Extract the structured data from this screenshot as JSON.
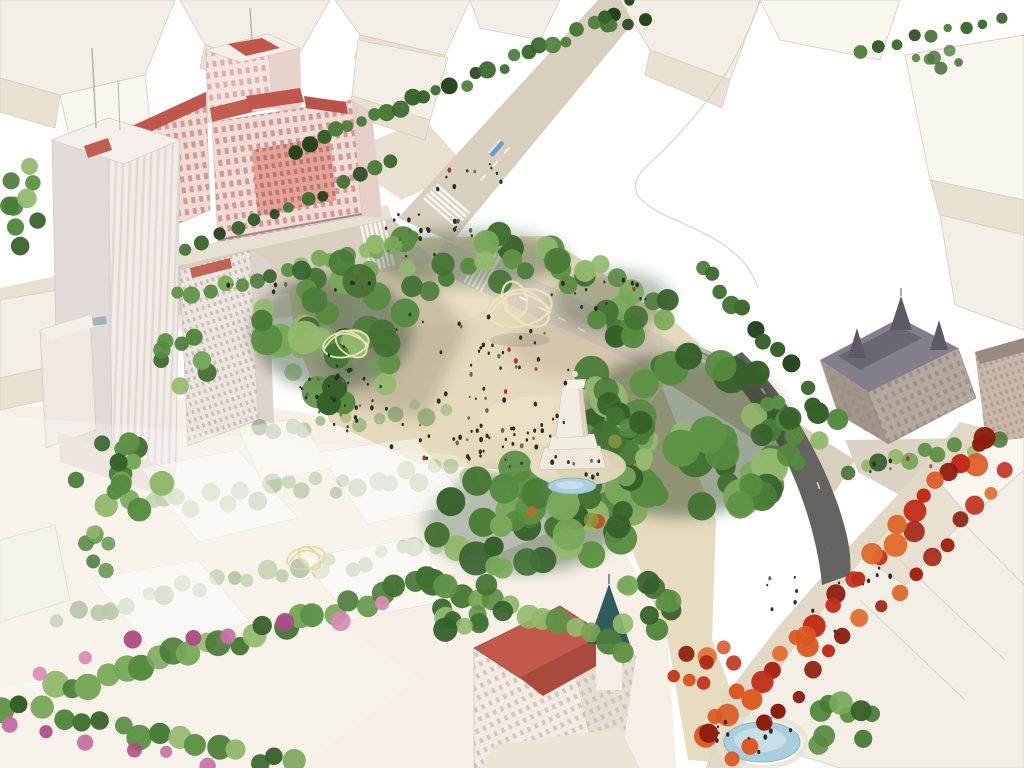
{
  "scene": {
    "kind": "aerial-architectural-rendering",
    "landmarks": [
      "edificio-espana-pink-highrise",
      "torre-de-madrid-tower",
      "white-massing-context-blocks",
      "street-intersection-with-crosswalks",
      "central-sand-plaza-with-crowd",
      "wireframe-canopy-sculptures",
      "cervantes-monument-with-pool",
      "dense-park-canopy",
      "red-autumn-tree-avenue",
      "ornate-mansard-roof-building",
      "casa-gallardo-turret-building",
      "oval-pond",
      "ghosted-future-phase-tree-rows",
      "pink-flowering-tree-band"
    ]
  },
  "palette": {
    "bg": "#ffffff",
    "massing_face": "#f3efe7",
    "massing_side": "#e8e1d2",
    "massing_top": "#f9f6f0",
    "massing_line": "#d5cdbd",
    "road": "#d9cfbf",
    "sidewalk": "#e8e0d0",
    "asphalt": "#63635f",
    "sand": "#e6dabc",
    "ghost_ground": "#f6f0e6",
    "espana_wall": "#f0dcd7",
    "espana_pink": "#e3a49c",
    "roof_red": "#bf574d",
    "torre_light": "#f1ebe7",
    "torre_dark": "#e2dad6",
    "stone": "#b5a89d",
    "mansard": "#6c6673",
    "teal_roof": "#2f5a60",
    "casa_roof": "#c2594b",
    "water": "#a9cedd",
    "water_light": "#cde4ec",
    "people_dark": "#2e2c28",
    "people_red": "#b03228"
  },
  "veg_palettes": {
    "g": [
      "#35602a",
      "#4a7c38",
      "#5f9246",
      "#79a85a",
      "#437233",
      "#568a40",
      "#93b96d"
    ],
    "gd": [
      "#24431d",
      "#35602a",
      "#3f6c2f",
      "#4a7c38"
    ],
    "rd": [
      "#c22d18",
      "#8e1c0d",
      "#dc5722",
      "#a62413",
      "#e06c2d"
    ],
    "pk": [
      "#c76fa3",
      "#d98ab7",
      "#ad4f85"
    ],
    "gh": [
      "#6f9c55",
      "#85ad68",
      "#5c8a47"
    ],
    "ac": [
      "#b9712f",
      "#c24a22",
      "#8a9a3e"
    ]
  },
  "vegetation": [
    {
      "l": "ghost",
      "t": "r",
      "x1": 255,
      "y1": 432,
      "x2": 445,
      "y2": 408,
      "n": 12,
      "rmin": 5,
      "rmax": 9,
      "p": "gh",
      "j": 10
    },
    {
      "l": "ghost",
      "t": "r",
      "x1": 148,
      "y1": 508,
      "x2": 468,
      "y2": 468,
      "n": 22,
      "rmin": 6,
      "rmax": 10,
      "p": "gh",
      "j": 12
    },
    {
      "l": "ghost",
      "t": "r",
      "x1": 62,
      "y1": 612,
      "x2": 452,
      "y2": 546,
      "n": 24,
      "rmin": 6,
      "rmax": 10,
      "p": "gh",
      "j": 12
    },
    {
      "l": "ghost",
      "t": "b",
      "cx": 330,
      "cy": 352,
      "rx": 60,
      "ry": 26,
      "n": 8,
      "rmin": 6,
      "rmax": 10,
      "p": "gh"
    },
    {
      "t": "r",
      "x1": 298,
      "y1": 150,
      "x2": 592,
      "y2": 28,
      "n": 24,
      "rmin": 5,
      "rmax": 9,
      "p": "gd",
      "j": 7
    },
    {
      "t": "b",
      "cx": 622,
      "cy": 14,
      "rx": 26,
      "ry": 14,
      "n": 7,
      "rmin": 5,
      "rmax": 8,
      "p": "gd"
    },
    {
      "t": "r",
      "x1": 862,
      "y1": 52,
      "x2": 1002,
      "y2": 16,
      "n": 9,
      "rmin": 4,
      "rmax": 7,
      "p": "gd",
      "j": 6
    },
    {
      "t": "b",
      "cx": 20,
      "cy": 195,
      "rx": 22,
      "ry": 55,
      "n": 9,
      "rmin": 6,
      "rmax": 10,
      "p": "g"
    },
    {
      "t": "r",
      "x1": 186,
      "y1": 252,
      "x2": 392,
      "y2": 164,
      "n": 13,
      "rmin": 5,
      "rmax": 8,
      "p": "gd",
      "j": 6
    },
    {
      "t": "r",
      "x1": 178,
      "y1": 296,
      "x2": 410,
      "y2": 240,
      "n": 16,
      "rmin": 6,
      "rmax": 9,
      "p": "g",
      "j": 6
    },
    {
      "t": "b",
      "cx": 132,
      "cy": 472,
      "rx": 72,
      "ry": 38,
      "n": 15,
      "rmin": 8,
      "rmax": 13,
      "p": "g"
    },
    {
      "t": "b",
      "cx": 186,
      "cy": 362,
      "rx": 26,
      "ry": 40,
      "n": 8,
      "rmin": 6,
      "rmax": 10,
      "p": "g"
    },
    {
      "t": "b",
      "cx": 332,
      "cy": 332,
      "rx": 82,
      "ry": 72,
      "n": 34,
      "rmin": 9,
      "rmax": 17,
      "p": "g"
    },
    {
      "t": "b",
      "cx": 470,
      "cy": 258,
      "rx": 105,
      "ry": 36,
      "n": 22,
      "rmin": 8,
      "rmax": 14,
      "p": "g"
    },
    {
      "t": "b",
      "cx": 612,
      "cy": 300,
      "rx": 68,
      "ry": 38,
      "n": 18,
      "rmin": 8,
      "rmax": 13,
      "p": "g"
    },
    {
      "t": "b",
      "cx": 678,
      "cy": 432,
      "rx": 118,
      "ry": 92,
      "n": 52,
      "rmin": 10,
      "rmax": 19,
      "p": "g"
    },
    {
      "t": "b",
      "cx": 522,
      "cy": 520,
      "rx": 105,
      "ry": 58,
      "n": 36,
      "rmin": 9,
      "rmax": 17,
      "p": "g"
    },
    {
      "t": "b",
      "cx": 560,
      "cy": 480,
      "rx": 90,
      "ry": 50,
      "n": 6,
      "rmin": 5,
      "rmax": 9,
      "p": "ac",
      "o": 0.9
    },
    {
      "t": "b",
      "cx": 622,
      "cy": 440,
      "rx": 42,
      "ry": 38,
      "n": 12,
      "rmin": 7,
      "rmax": 12,
      "p": "g"
    },
    {
      "t": "r",
      "x1": 700,
      "y1": 262,
      "x2": 788,
      "y2": 360,
      "n": 9,
      "rmin": 7,
      "rmax": 11,
      "p": "gd",
      "j": 8
    },
    {
      "t": "b",
      "cx": 800,
      "cy": 428,
      "rx": 42,
      "ry": 42,
      "n": 14,
      "rmin": 7,
      "rmax": 12,
      "p": "g"
    },
    {
      "t": "r",
      "x1": 852,
      "y1": 470,
      "x2": 1000,
      "y2": 442,
      "n": 11,
      "rmin": 6,
      "rmax": 9,
      "p": "g",
      "j": 8
    },
    {
      "t": "b",
      "cx": 940,
      "cy": 58,
      "rx": 26,
      "ry": 14,
      "n": 6,
      "rmin": 4,
      "rmax": 7,
      "p": "gd",
      "o": 0.85
    },
    {
      "t": "r",
      "x1": 990,
      "y1": 438,
      "x2": 702,
      "y2": 742,
      "n": 30,
      "rmin": 7,
      "rmax": 12,
      "p": "rd",
      "j": 14
    },
    {
      "t": "r",
      "x1": 1008,
      "y1": 472,
      "x2": 734,
      "y2": 758,
      "n": 18,
      "rmin": 6,
      "rmax": 10,
      "p": "rd",
      "j": 10
    },
    {
      "t": "b",
      "cx": 700,
      "cy": 668,
      "rx": 36,
      "ry": 30,
      "n": 8,
      "rmin": 6,
      "rmax": 10,
      "p": "rd"
    },
    {
      "t": "r",
      "x1": 58,
      "y1": 690,
      "x2": 428,
      "y2": 582,
      "n": 24,
      "rmin": 9,
      "rmax": 14,
      "p": "g",
      "j": 10
    },
    {
      "t": "r",
      "x1": 428,
      "y1": 584,
      "x2": 622,
      "y2": 648,
      "n": 13,
      "rmin": 8,
      "rmax": 13,
      "p": "g",
      "j": 9
    },
    {
      "t": "r",
      "x1": 42,
      "y1": 662,
      "x2": 382,
      "y2": 602,
      "n": 8,
      "rmin": 6,
      "rmax": 10,
      "p": "pk",
      "j": 18
    },
    {
      "t": "r",
      "x1": 2,
      "y1": 706,
      "x2": 298,
      "y2": 766,
      "n": 16,
      "rmin": 8,
      "rmax": 13,
      "p": "g",
      "j": 9
    },
    {
      "t": "r",
      "x1": 10,
      "y1": 722,
      "x2": 210,
      "y2": 764,
      "n": 6,
      "rmin": 6,
      "rmax": 9,
      "p": "pk",
      "j": 10
    },
    {
      "t": "b",
      "cx": 470,
      "cy": 612,
      "rx": 38,
      "ry": 34,
      "n": 11,
      "rmin": 8,
      "rmax": 13,
      "p": "g"
    },
    {
      "t": "b",
      "cx": 644,
      "cy": 598,
      "rx": 32,
      "ry": 42,
      "n": 11,
      "rmin": 8,
      "rmax": 13,
      "p": "g"
    },
    {
      "t": "b",
      "cx": 836,
      "cy": 722,
      "rx": 38,
      "ry": 28,
      "n": 9,
      "rmin": 7,
      "rmax": 12,
      "p": "g"
    },
    {
      "t": "b",
      "cx": 92,
      "cy": 552,
      "rx": 30,
      "ry": 22,
      "n": 7,
      "rmin": 6,
      "rmax": 10,
      "p": "g",
      "o": 0.85
    }
  ],
  "people_areas": [
    {
      "cx": 450,
      "cy": 388,
      "rx": 138,
      "ry": 78,
      "n": 80
    },
    {
      "cx": 332,
      "cy": 402,
      "rx": 40,
      "ry": 38,
      "n": 16
    },
    {
      "cx": 505,
      "cy": 448,
      "rx": 52,
      "ry": 26,
      "n": 24
    },
    {
      "cx": 420,
      "cy": 236,
      "rx": 52,
      "ry": 24,
      "n": 20
    },
    {
      "cx": 588,
      "cy": 296,
      "rx": 66,
      "ry": 20,
      "n": 14
    },
    {
      "cx": 470,
      "cy": 182,
      "rx": 38,
      "ry": 22,
      "n": 10
    },
    {
      "cx": 578,
      "cy": 468,
      "rx": 38,
      "ry": 14,
      "n": 9
    },
    {
      "cx": 830,
      "cy": 600,
      "rx": 80,
      "ry": 60,
      "n": 16
    },
    {
      "cx": 756,
      "cy": 734,
      "rx": 44,
      "ry": 18,
      "n": 11
    },
    {
      "cx": 300,
      "cy": 282,
      "rx": 78,
      "ry": 16,
      "n": 12
    },
    {
      "cx": 900,
      "cy": 468,
      "rx": 36,
      "ry": 10,
      "n": 6
    }
  ]
}
